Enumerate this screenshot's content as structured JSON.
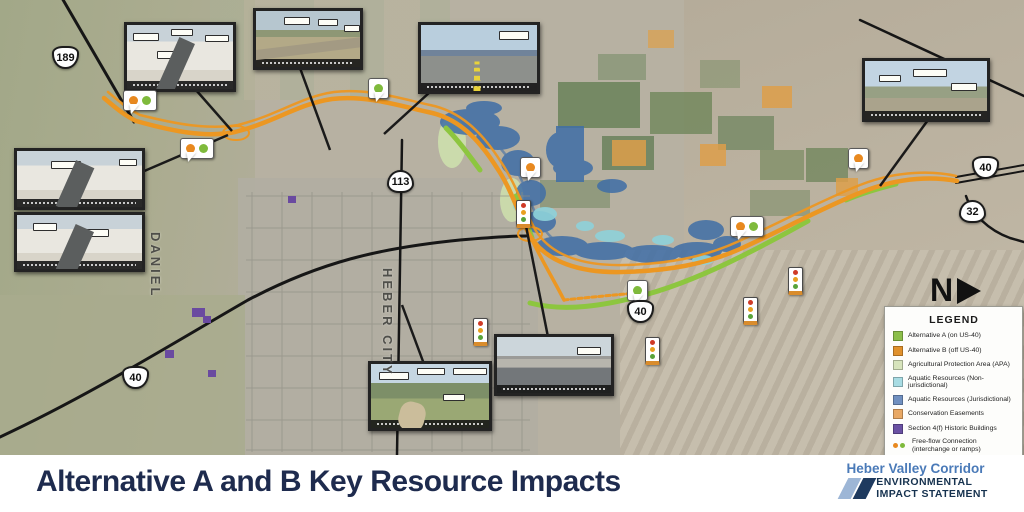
{
  "map": {
    "place_labels": [
      {
        "text": "DANIEL"
      },
      {
        "text": "HEBER CITY"
      }
    ],
    "north_label": "N",
    "shields": [
      {
        "type": "us",
        "label": "189"
      },
      {
        "type": "state",
        "label": "113"
      },
      {
        "type": "us",
        "label": "40"
      },
      {
        "type": "state",
        "label": "32"
      },
      {
        "type": "us",
        "label": "40"
      },
      {
        "type": "us",
        "label": "40"
      }
    ]
  },
  "legend": {
    "title": "LEGEND",
    "items": [
      {
        "label": "Alternative A (on US-40)",
        "swatch": "fill",
        "color": "#8cbf4a"
      },
      {
        "label": "Alternative B (off US-40)",
        "swatch": "fill",
        "color": "#e0912c"
      },
      {
        "label": "Agricultural Protection Area (APA)",
        "swatch": "fill",
        "color": "#d7e4bc"
      },
      {
        "label": "Aquatic Resources (Non-jurisdictional)",
        "swatch": "fill",
        "color": "#a8dce3"
      },
      {
        "label": "Aquatic Resources (Jurisdictional)",
        "swatch": "fill",
        "color": "#7090c0"
      },
      {
        "label": "Conservation Easements",
        "swatch": "fill",
        "color": "#e8a864"
      },
      {
        "label": "Section 4(f) Historic Buildings",
        "swatch": "fill",
        "color": "#6a51a3"
      },
      {
        "label": "Free-flow Connection (interchange or ramps)",
        "swatch": "dots"
      },
      {
        "label": "Signalized Intersection",
        "swatch": "signal"
      }
    ]
  },
  "footer": {
    "title": "Alternative A and B Key Resource Impacts",
    "logo_line1": "Heber Valley Corridor",
    "logo_line2": "ENVIRONMENTAL",
    "logo_line3": "IMPACT STATEMENT"
  },
  "colors": {
    "alt_a_green": "#8dc63f",
    "alt_b_orange": "#ec9722",
    "title_navy": "#1e2b4e",
    "logo_blue": "#4a7ab8"
  }
}
